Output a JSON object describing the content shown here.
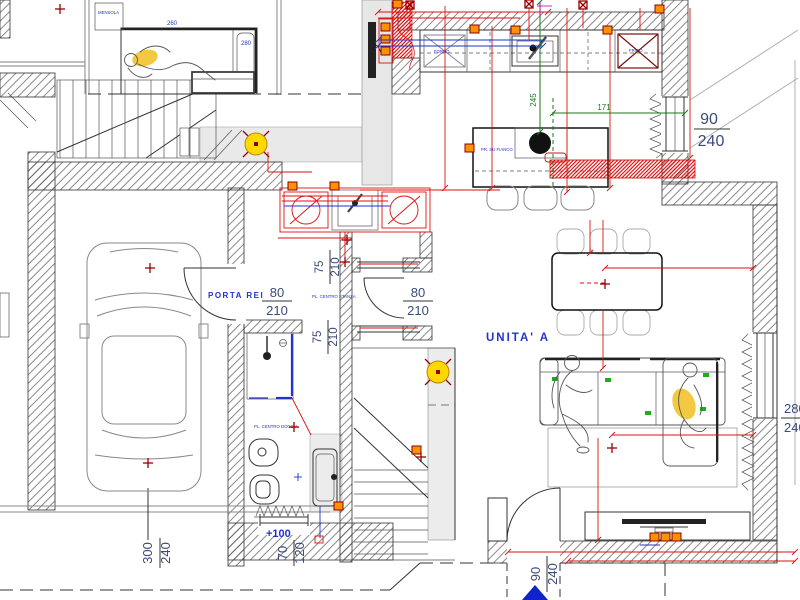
{
  "labels": {
    "unit": "UNITA' A",
    "fire_door": "PORTA REI",
    "level": "+100",
    "shelf": "MENSOLA",
    "bed_w": "260",
    "bed_d": "280",
    "oven": "FORNO",
    "fridge": "FRIGO",
    "outlet_side": "PR. SU FIANCO",
    "ceiling_room": "PL. CENTRO STANZA",
    "ceiling_shower": "PL. CENTRO DOCCIA"
  },
  "dims": {
    "fire_door": {
      "w": "80",
      "h": "210"
    },
    "living_door": {
      "w": "80",
      "h": "210"
    },
    "passage_top": {
      "w": "75",
      "h": "210"
    },
    "passage_bottom": {
      "w": "75",
      "h": "210"
    },
    "kitchen_window": {
      "w": "90",
      "h": "240"
    },
    "entry_door": {
      "w": "90",
      "h": "240"
    },
    "garage_door": {
      "w": "300",
      "h": "240"
    },
    "bath_window": {
      "w": "70",
      "h": "120"
    },
    "living_window": {
      "w": "280",
      "h": "240"
    },
    "island_span": "171",
    "island_depth": "245"
  },
  "colors": {
    "dimension_red": "#dd1111",
    "dimension_green": "#1a7a1a",
    "label_blue": "#2233cc",
    "dimension_navy": "#3b4a7a",
    "lamp_yellow": "#ffd800",
    "outlet_orange": "#ff9000"
  }
}
